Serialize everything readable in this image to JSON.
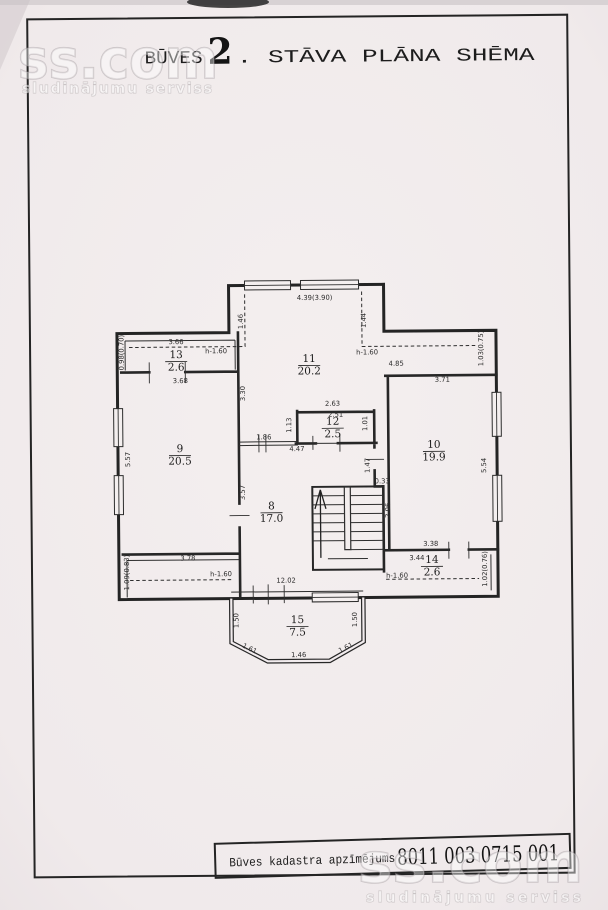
{
  "title": {
    "building": "BŪVES",
    "floor_number": "2",
    "suffix": ". STĀVA PLĀNA SHĒMA"
  },
  "watermark": {
    "brand": "ss.com",
    "tagline": "sludinājumu serviss"
  },
  "footer": {
    "label": "Būves kadastra apzīmējums",
    "value": "8011 003 0715 001"
  },
  "rooms": [
    {
      "number": "8",
      "area": "17.0"
    },
    {
      "number": "9",
      "area": "20.5"
    },
    {
      "number": "10",
      "area": "19.9"
    },
    {
      "number": "11",
      "area": "20.2"
    },
    {
      "number": "12",
      "area": "2.5"
    },
    {
      "number": "13",
      "area": "2.6"
    },
    {
      "number": "14",
      "area": "2.6"
    },
    {
      "number": "15",
      "area": "7.5"
    }
  ],
  "dims": {
    "d_439": "4.39(3.90)",
    "d_146v": "1.46",
    "d_144v": "1.44",
    "d_h160_a": "h-1.60",
    "d_h160_b": "h-1.60",
    "d_h160_c": "h-1.60",
    "d_h160_d": "h-1.60",
    "d_366": "3.66",
    "d_368": "3.68",
    "d_098": "0.98(0.70)",
    "d_330": "3.30",
    "d_557": "5.57",
    "d_485": "4.85",
    "d_103": "1.03(0.75)",
    "d_371": "3.71",
    "d_263": "2.63",
    "d_251": "2.51",
    "d_113": "1.13",
    "d_101": "1.01",
    "d_186": "1.86",
    "d_447": "4.47",
    "d_147": "1.47",
    "d_033": "0.33",
    "d_206": "2.06",
    "d_554": "5.54",
    "d_357": "3.57",
    "d_378": "3.78",
    "d_109": "1.09(0.83)",
    "d_1202": "12.02",
    "d_338": "3.38",
    "d_344": "3.44",
    "d_102": "1.02(0.76)",
    "d_150l": "1.50",
    "d_150r": "1.50",
    "d_161l": "1.61",
    "d_161r": "1.61",
    "d_146b": "1.46"
  },
  "colors": {
    "ink": "#272727",
    "paper": "#f1ebec",
    "watermark_gray": "#9b9497"
  }
}
